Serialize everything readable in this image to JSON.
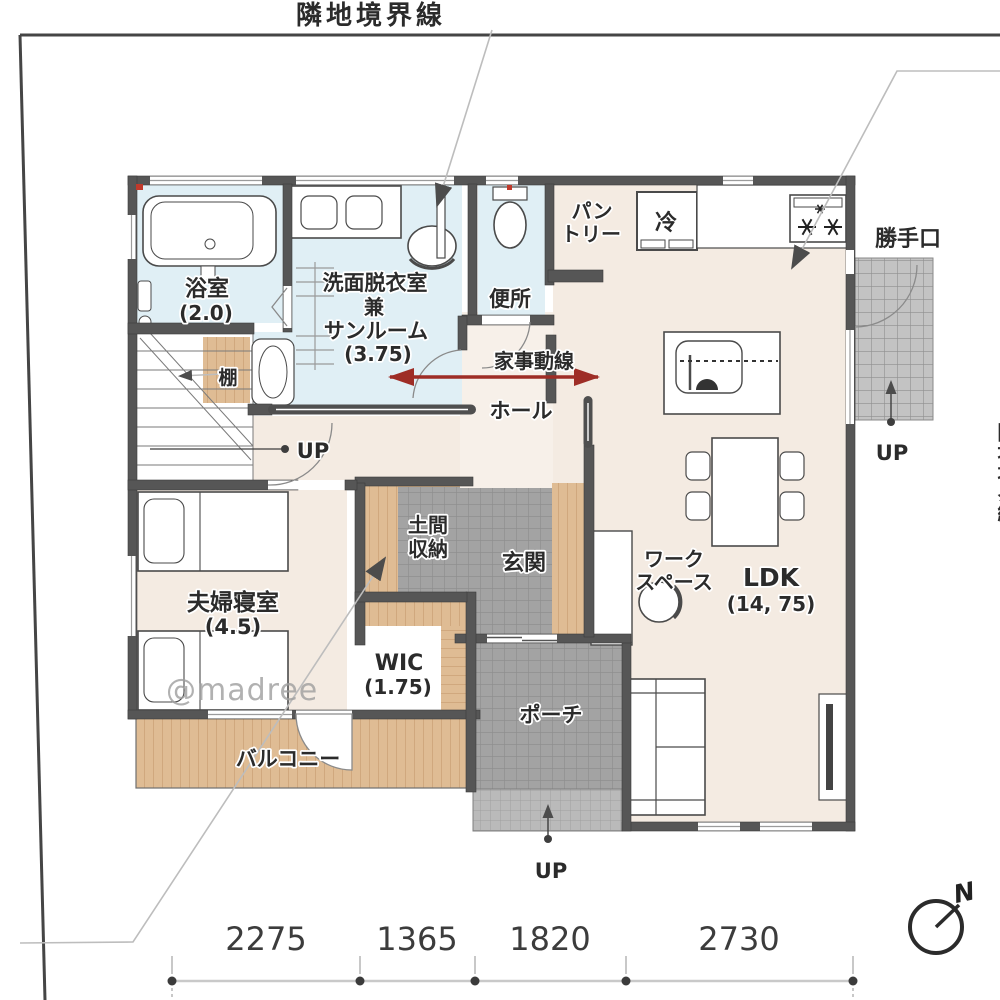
{
  "boundary": {
    "top_label": "隣地境界線",
    "right_label": "隣地境界線"
  },
  "rooms": {
    "bath": {
      "name": "浴室",
      "size": "(2.0)"
    },
    "washroom": {
      "name_line1": "洗面脱衣室",
      "name_line2": "兼",
      "name_line3": "サンルーム",
      "size": "(3.75)"
    },
    "toilet": {
      "name": "便所"
    },
    "pantry": {
      "name_line1": "パン",
      "name_line2": "トリー"
    },
    "refrigerator": {
      "name": "冷"
    },
    "back_door": {
      "name": "勝手口",
      "up": "UP"
    },
    "hall": {
      "name": "ホール"
    },
    "stairs": {
      "up": "UP"
    },
    "shelf": {
      "name": "棚"
    },
    "bedroom": {
      "name": "夫婦寝室",
      "size": "(4.5)"
    },
    "doma_storage": {
      "name_line1": "土間",
      "name_line2": "収納"
    },
    "entrance": {
      "name": "玄関"
    },
    "wic": {
      "name": "WIC",
      "size": "(1.75)"
    },
    "workspace": {
      "name_line1": "ワーク",
      "name_line2": "スペース"
    },
    "ldk": {
      "name": "LDK",
      "size": "(14, 75)"
    },
    "porch": {
      "name": "ポーチ",
      "up": "UP"
    },
    "balcony": {
      "name": "バルコニー"
    }
  },
  "annotations": {
    "housework_flow": "家事動線",
    "watermark": "@madree",
    "compass_north": "N"
  },
  "dimensions": {
    "values": [
      "2275",
      "1365",
      "1820",
      "2730"
    ]
  },
  "colors": {
    "wall": "#565656",
    "wet_room": "#e0eff5",
    "floor": "#f4ebe2",
    "wood": "#dfbc94",
    "tile": "#a3a3a3",
    "flow_arrow": "#9e2d26",
    "boundary_line": "#454545",
    "leader_line": "#bdbdbd"
  }
}
